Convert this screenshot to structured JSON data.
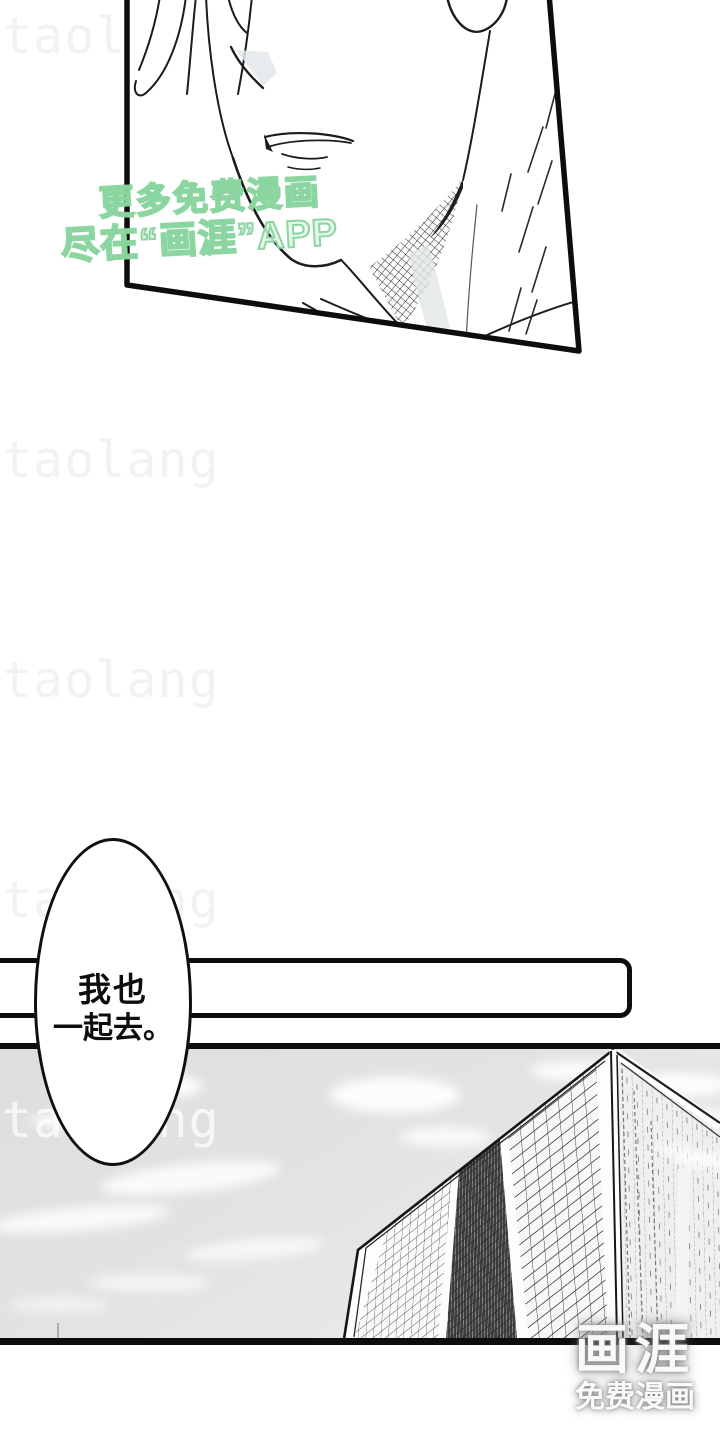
{
  "watermarks": {
    "tiled_text": "taolang",
    "promo": {
      "line1": "更多免费漫画",
      "line2": "尽在“画涯”APP",
      "color": "#86d49c"
    }
  },
  "speech_bubble": {
    "line1": "我也",
    "line2": "一起去。"
  },
  "logo": {
    "name": "画涯",
    "tagline": "免费漫画"
  },
  "colors": {
    "ink": "#0d0d0d",
    "page_background": "#ffffff",
    "sky": "#e2e2e2",
    "tiled_watermark": "#f2f2f2",
    "promo_green": "#86d49c"
  }
}
